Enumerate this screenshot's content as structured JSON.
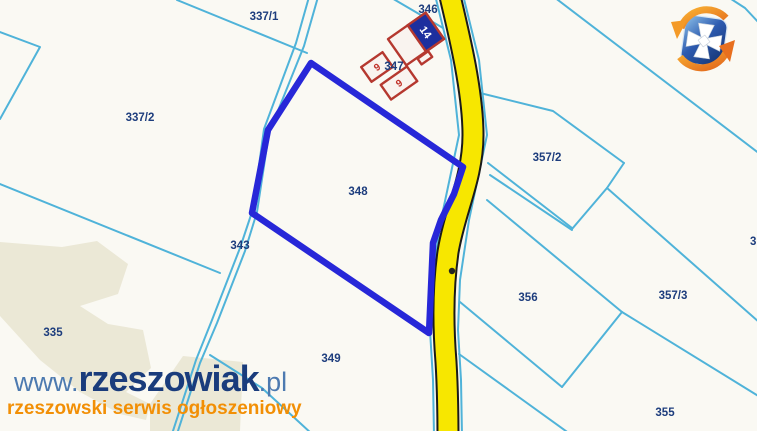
{
  "map": {
    "highlighted_parcel": "348",
    "parcel_labels": [
      {
        "id": "337/1"
      },
      {
        "id": "346"
      },
      {
        "id": "337/2"
      },
      {
        "id": "347"
      },
      {
        "id": "357/2"
      },
      {
        "id": "348"
      },
      {
        "id": "343"
      },
      {
        "id": "3"
      },
      {
        "id": "335"
      },
      {
        "id": "356"
      },
      {
        "id": "357/3"
      },
      {
        "id": "349"
      },
      {
        "id": "355"
      }
    ],
    "building_labels": [
      {
        "n": "14"
      },
      {
        "n": "9"
      },
      {
        "n": "9"
      }
    ]
  },
  "watermark": {
    "prefix": "www.",
    "brand": "rzeszowiak",
    "suffix": ".pl",
    "tagline": "rzeszowski serwis ogłoszeniowy"
  },
  "colors": {
    "background": "#faf9f3",
    "landuse_beige": "#ebe8d6",
    "boundary_cyan": "#4fb3d9",
    "highlight_blue": "#2727d8",
    "road_yellow": "#f7e700",
    "road_casing": "#1a1a1a",
    "label_navy": "#1d3d7d",
    "building_red": "#b5382f",
    "building_blue": "#1d2f9e",
    "watermark_navy": "#1a3c7c",
    "watermark_steel": "#4d7ab0",
    "watermark_orange": "#f28f05"
  }
}
